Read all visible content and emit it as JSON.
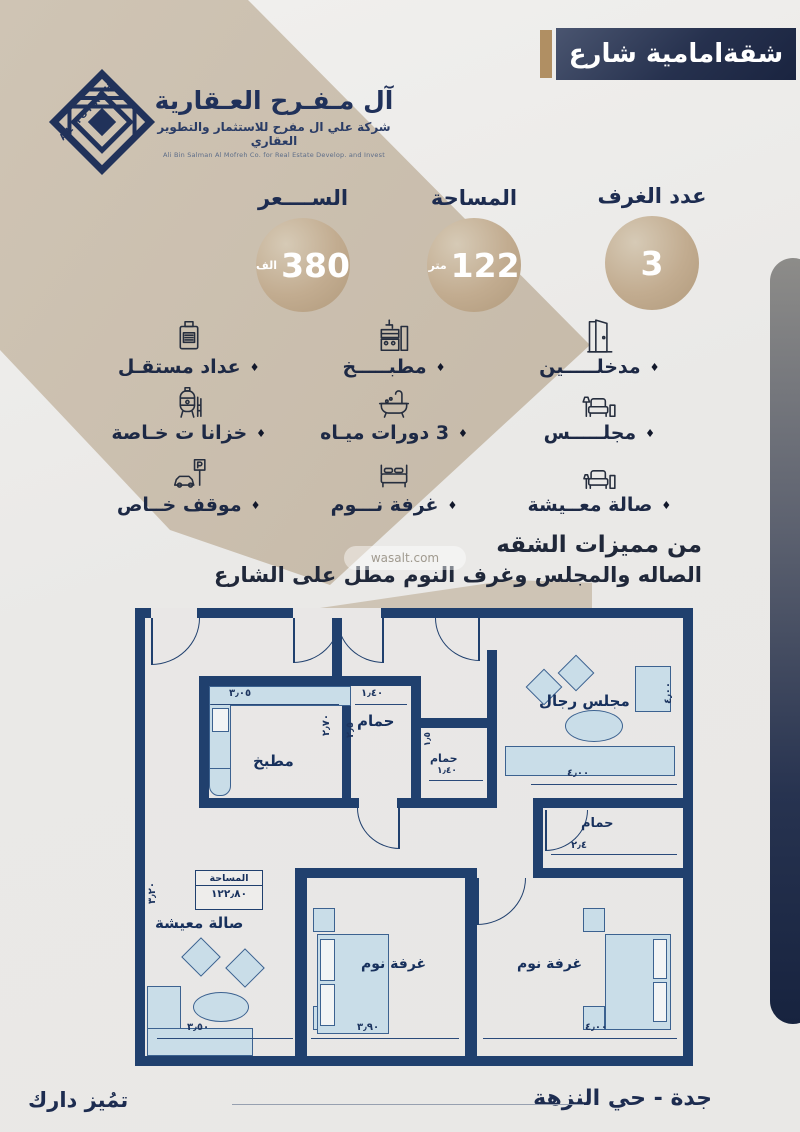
{
  "banner": {
    "title": "شقةامامية شارع"
  },
  "logo": {
    "mark": "ALMOFREH",
    "title": "آل مـفـرح العـقارية",
    "subtitle": "شركة علي ال مفرح للاستثمار والتطوير العقاري",
    "subtitle_en": "Ali Bin Salman Al Mofreh Co. for Real Estate Develop. and Invest"
  },
  "stats": {
    "price": {
      "label": "الســــعر",
      "value": "380",
      "unit": "الف"
    },
    "area": {
      "label": "المساحة",
      "value": "122",
      "unit": "متر"
    },
    "rooms": {
      "label": "عدد الغرف",
      "value": "3",
      "unit": ""
    }
  },
  "features": {
    "bullet": "♦",
    "entrances": "مدخلـــــين",
    "kitchen": "مطبـــــخ",
    "meter": "عداد مستقـل",
    "majlis": "مجلـــــس",
    "bathrooms": "3 دورات ميـاه",
    "tanks": "خزانا ت خـاصة",
    "living": "صالة معــيشة",
    "bedroom": "غرفة نـــوم",
    "parking": "موقف خــاص"
  },
  "highlights": {
    "heading": "من مميزات الشقه",
    "line": "الصاله والمجلس وغرف النوم مطل على الشارع"
  },
  "watermark": "wasalt.com",
  "plan": {
    "labels": {
      "kitchen": "مطبخ",
      "bath1": "حمام",
      "bath2": "حمام",
      "bath3": "حمام",
      "mens_majlis": "مجلس رجال",
      "living": "صالة معيشة",
      "bedroom1": "غرفة نوم",
      "bedroom2": "غرفة نوم",
      "area_title": "المساحة",
      "area_value": "١٢٢٫٨٠"
    },
    "dims": {
      "kitchen_w": "٣٫٠٥",
      "kitchen_h": "٢٫٧٠",
      "bath1_w": "١٫٤٠",
      "bath1_h": "٢٫٥",
      "bath2_h": "١٫٥",
      "bath2_w": "١٫٤٠",
      "majlis_w": "٤٫٠٠",
      "majlis_h": "٤٫٠٠",
      "bath3_w": "٢٫٤",
      "living_h": "٣٫٢٠",
      "living_w": "٣٫٥٠",
      "bedroom1_w": "٣٫٩٠",
      "bedroom2_w": "٤٫٠٠"
    }
  },
  "footer": {
    "location": "جدة - حي النزهة",
    "tagline": "تمُيز دارك"
  }
}
